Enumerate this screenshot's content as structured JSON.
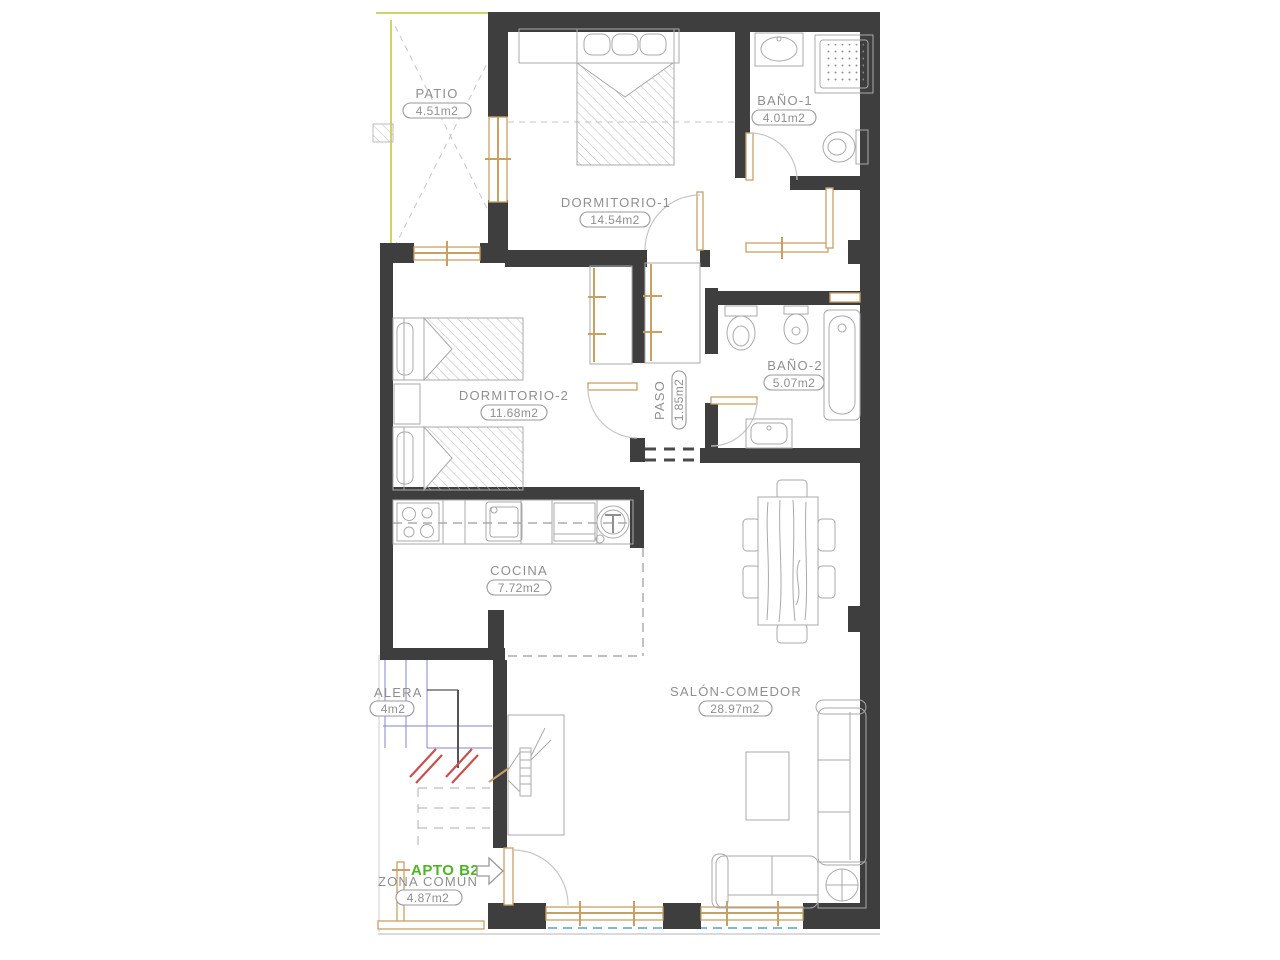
{
  "plan_type": "apartment-floor-plan",
  "rooms": [
    {
      "name": "PATIO",
      "area": "4.51m2"
    },
    {
      "name": "DORMITORIO-1",
      "area": "14.54m2"
    },
    {
      "name": "BAÑO-1",
      "area": "4.01m2"
    },
    {
      "name": "DORMITORIO-2",
      "area": "11.68m2"
    },
    {
      "name": "PASO",
      "area": "1.85m2"
    },
    {
      "name": "BAÑO-2",
      "area": "5.07m2"
    },
    {
      "name": "COCINA",
      "area": "7.72m2"
    },
    {
      "name": "SALÓN-COMEDOR",
      "area": "28.97m2"
    },
    {
      "name": "ALERA",
      "area": "4m2"
    },
    {
      "name": "ZONA COMÚN",
      "area": "4.87m2"
    }
  ],
  "apartment": {
    "label": "APTO B2"
  },
  "colors": {
    "wall": "#3e3e3e",
    "carpentry_wood": "#c9a063",
    "label_text": "#8f8f8f",
    "patio_boundary_green": "#b9c832",
    "apartment_label_green": "#4db526",
    "terrace_dashed_blue": "#5ba0c4",
    "stair_blue": "#8585cd",
    "section_mark_red": "#c85050"
  }
}
